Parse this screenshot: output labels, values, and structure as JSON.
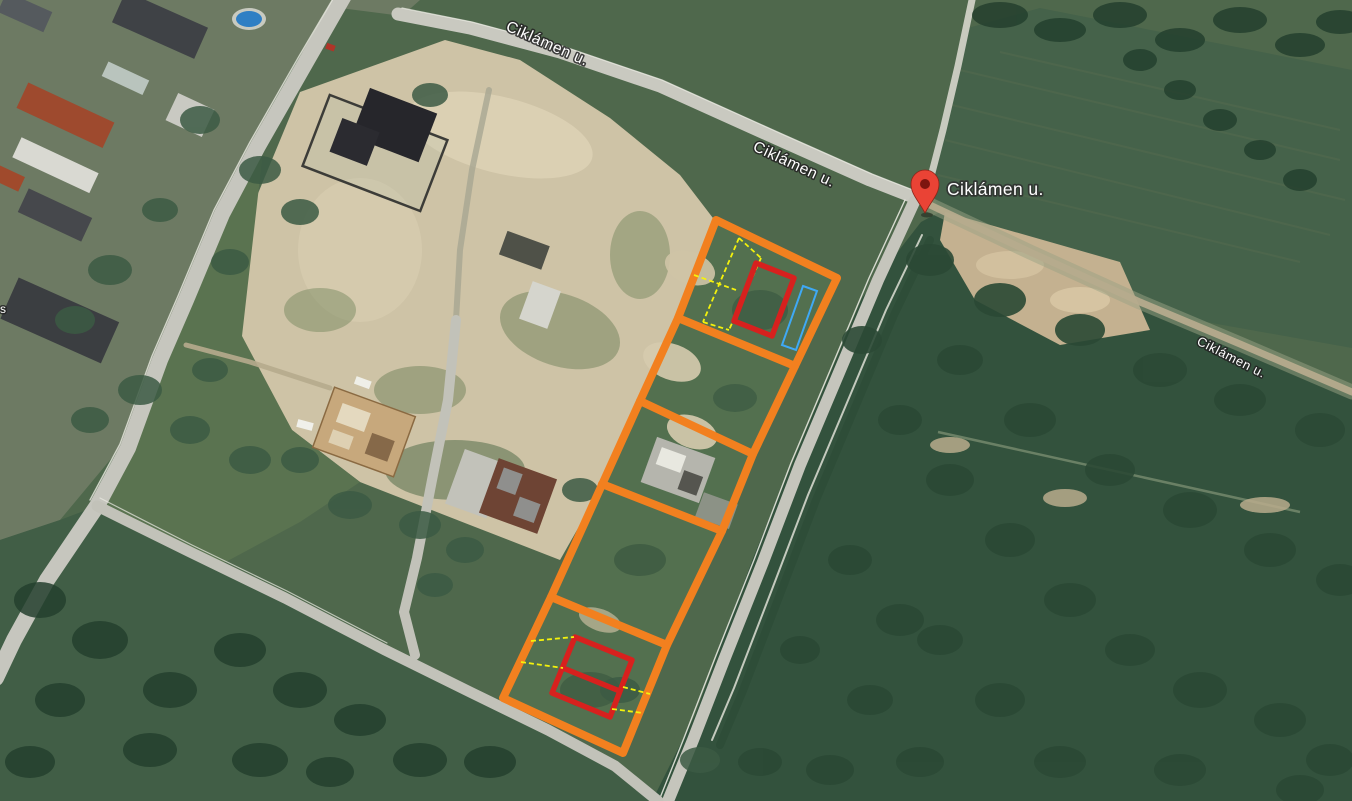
{
  "map": {
    "view": "satellite",
    "street_labels": [
      {
        "id": "top",
        "text": "Ciklámen u."
      },
      {
        "id": "middle",
        "text": "Ciklámen u."
      },
      {
        "id": "right",
        "text": "Ciklámen u."
      }
    ],
    "pin": {
      "label": "Ciklámen u.",
      "color": "#ea4335",
      "inner_color": "#7e150f"
    },
    "edge_label_partial": "s",
    "annotations": {
      "parcel_outline_color": "#f2801f",
      "highlight_color": "#d7211e",
      "measure_line_color": "#f4f20c",
      "secondary_outline_color": "#3fa9f5"
    }
  }
}
